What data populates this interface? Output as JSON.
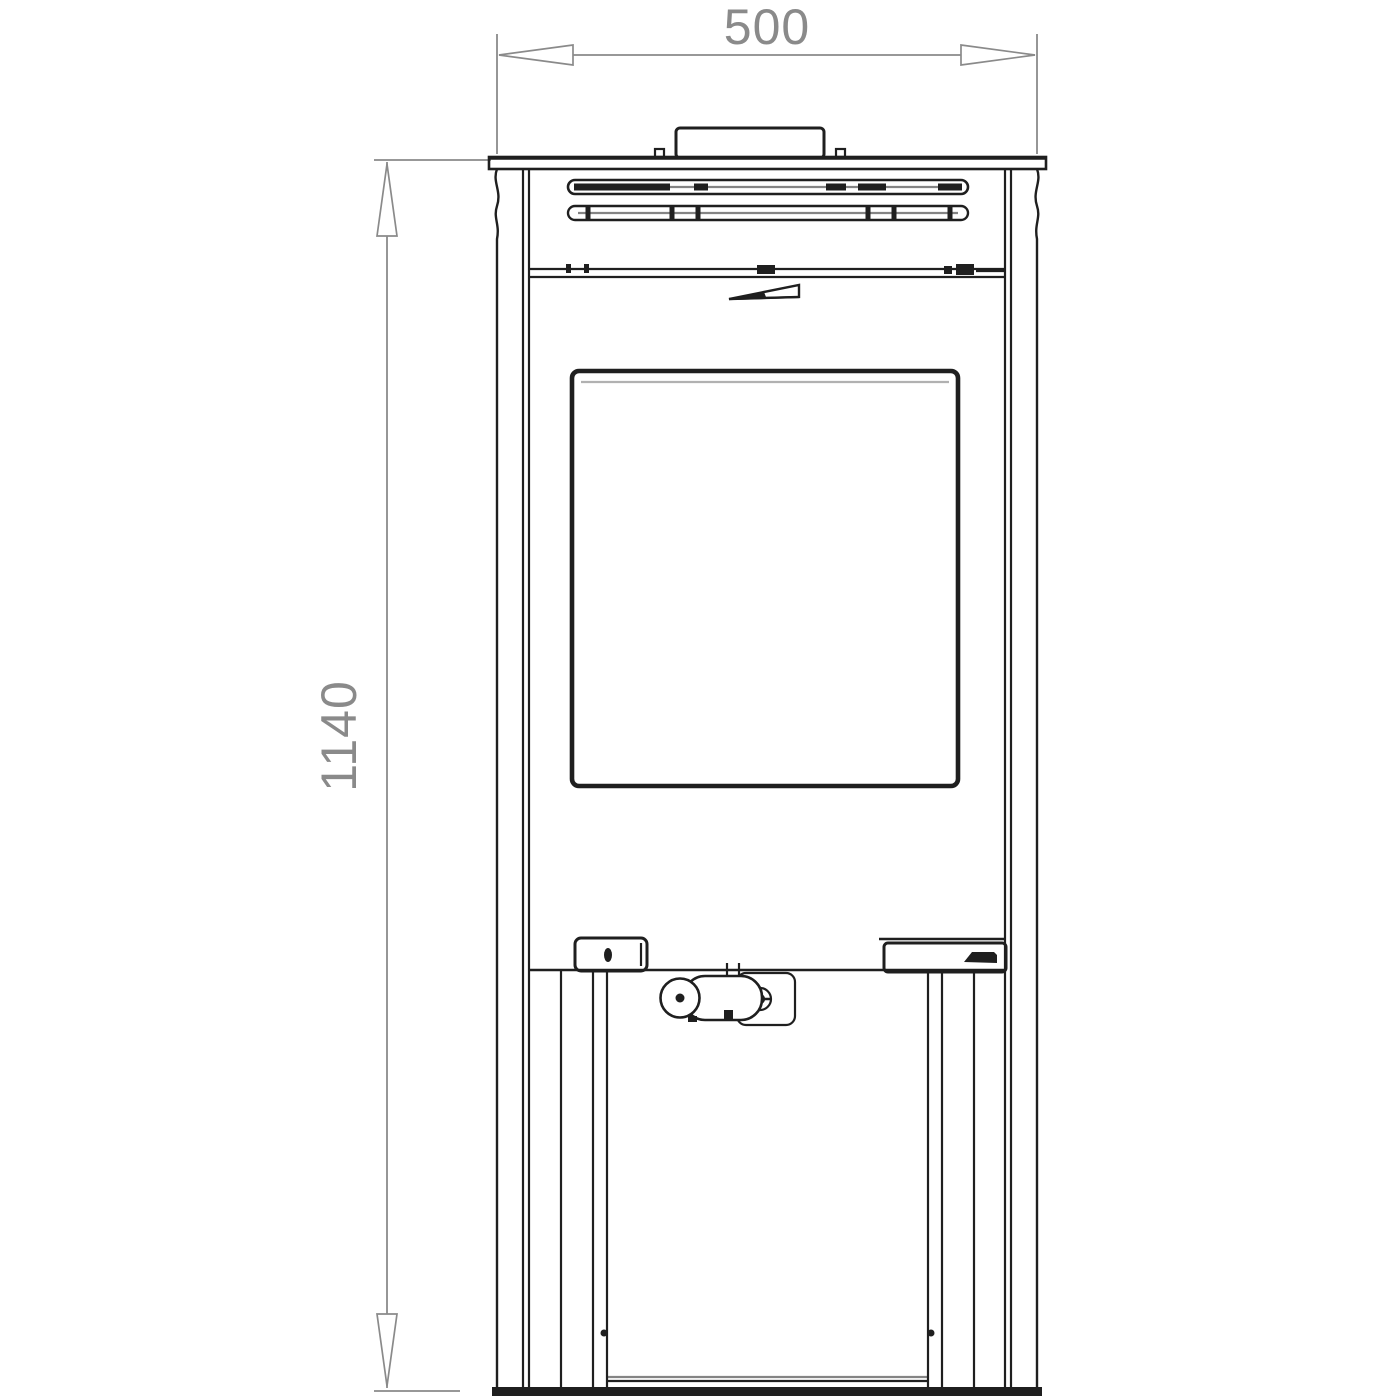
{
  "drawing": {
    "type": "technical-front-elevation",
    "subject": "freestanding wood stove, front view dimensional drawing",
    "dimensions": {
      "width_label": "500",
      "height_label": "1140"
    },
    "colors": {
      "line": "#1f1f1f",
      "dimension": "#8a8a8a",
      "background": "#ffffff"
    },
    "parts": [
      "flue-collar",
      "top-plate",
      "upper-vent-slot",
      "lower-vent-slot",
      "top-section-divider",
      "air-control-lever",
      "door-glass-window",
      "door-hinge-block",
      "door-latch-mechanism",
      "door-handle",
      "side-panels",
      "pedestal-base",
      "floor-base-bar"
    ]
  }
}
